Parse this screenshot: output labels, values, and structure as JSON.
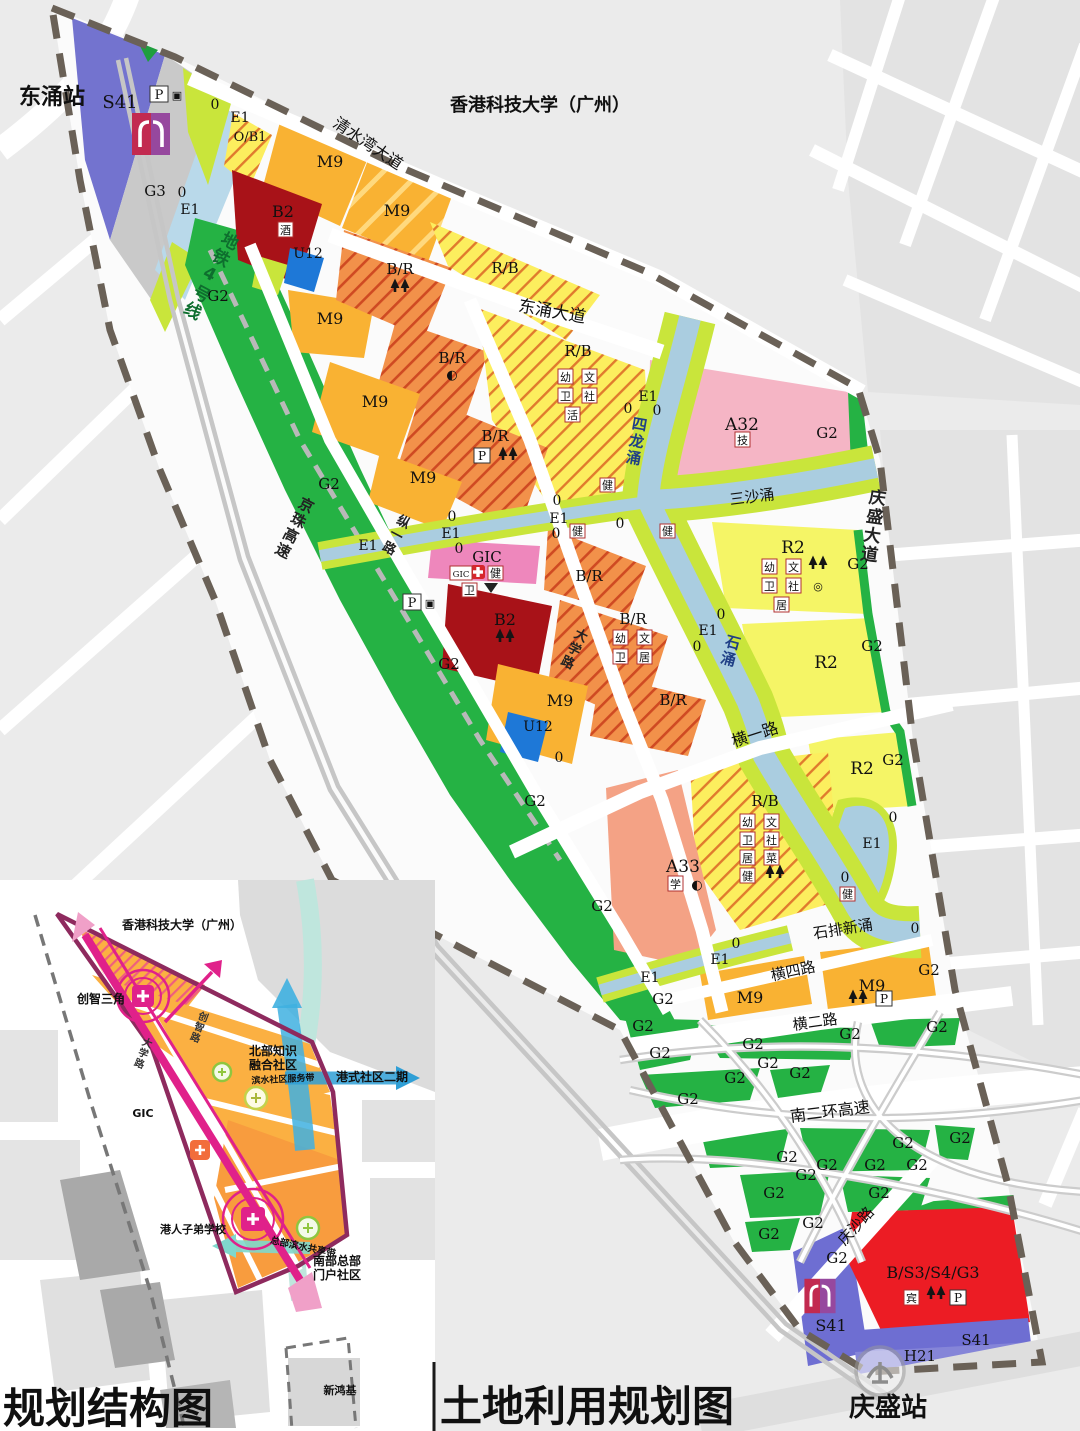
{
  "titles": {
    "structure_map": "规划结构图",
    "land_use_map": "土地利用规划图"
  },
  "stations": {
    "dongchong": "东涌站",
    "qingsheng": "庆盛站"
  },
  "landmarks": {
    "university": "香港科技大学（广州）"
  },
  "roads": {
    "qingshuiwan": "清水湾大道",
    "dongchong_ave": "东涌大道",
    "qingsheng_ave": "庆盛大道",
    "jingzhu_expwy": "京珠高速",
    "zongyi": "纵一路",
    "daxue": "大学路",
    "hengyi": "横一路",
    "hengsi": "横四路",
    "henger": "横二路",
    "nanerhuan_expwy": "南二环高速",
    "qingsha": "庆沙路",
    "metro_line4": "地铁4号线"
  },
  "rivers": {
    "silong": "四龙涌",
    "sansha": "三沙涌",
    "shi": "石涌",
    "shipaixin": "石排新涌"
  },
  "codes": {
    "s41": "S41",
    "g3": "G3",
    "g2": "G2",
    "o": "0",
    "e1": "E1",
    "ob1": "O/B1",
    "m9": "M9",
    "b2": "B2",
    "u12": "U12",
    "br": "B/R",
    "rb": "R/B",
    "a32": "A32",
    "a33": "A33",
    "r2": "R2",
    "gic": "GIC",
    "bs3s4g3": "B/S3/S4/G3",
    "h21": "H21"
  },
  "badges": {
    "you": "幼",
    "wen": "文",
    "wei": "卫",
    "she": "社",
    "ju": "居",
    "cai": "菜",
    "jian": "健",
    "huo": "活",
    "xue": "学",
    "ji": "技",
    "jiu": "酒",
    "bin": "宾",
    "p": "P",
    "moon": "◐",
    "target": "◎",
    "camera": "▣"
  },
  "inset": {
    "innovation_triangle": "创智三角",
    "chuangzhi_rd": "创智路",
    "daxue_rd": "大学路",
    "north_knowledge_line1": "北部知识",
    "north_knowledge_line2": "融合社区",
    "hk_community_phase2": "港式社区二期",
    "waterfront_service_belt": "滨水社区服务带",
    "hk_school": "港人子弟学校",
    "hq_waterfront_belt": "总部滨水共享带",
    "south_gateway_line1": "南部总部",
    "south_gateway_line2": "门户社区",
    "xinhongji": "新鸿基"
  }
}
